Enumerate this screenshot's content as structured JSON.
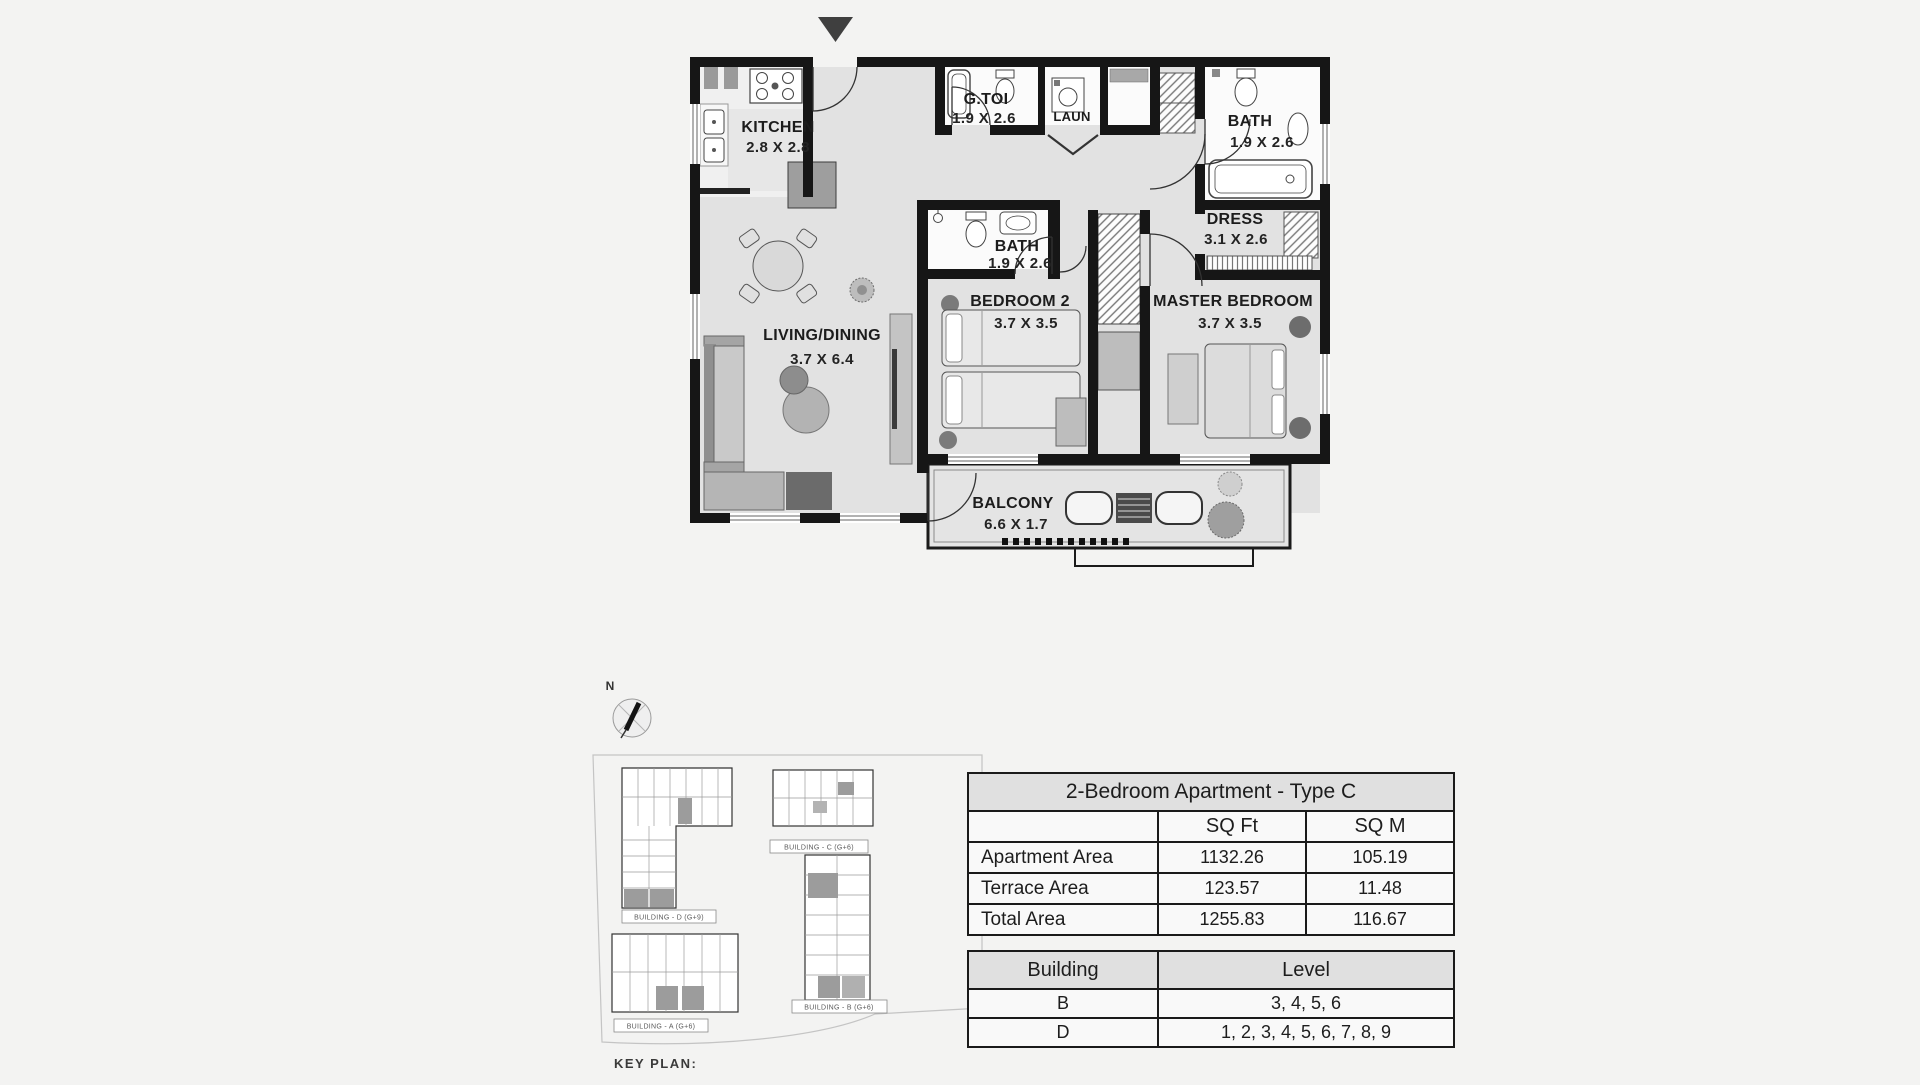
{
  "floor_plan": {
    "entrance_marker": "entrance-arrow",
    "rooms": [
      {
        "id": "kitchen",
        "name": "KITCHEN",
        "dims": "2.8 X 2.8"
      },
      {
        "id": "guest-toilet",
        "name": "G.TOI",
        "dims": "1.9 X 2.6"
      },
      {
        "id": "laundry",
        "name": "LAUN",
        "dims": ""
      },
      {
        "id": "bath-top",
        "name": "BATH",
        "dims": "1.9 X 2.6"
      },
      {
        "id": "dress",
        "name": "DRESS",
        "dims": "3.1 X 2.6"
      },
      {
        "id": "bath-mid",
        "name": "BATH",
        "dims": "1.9 X 2.6"
      },
      {
        "id": "bedroom2",
        "name": "BEDROOM 2",
        "dims": "3.7 X 3.5"
      },
      {
        "id": "master-bedroom",
        "name": "MASTER BEDROOM",
        "dims": "3.7 X 3.5"
      },
      {
        "id": "living-dining",
        "name": "LIVING/DINING",
        "dims": "3.7 X 6.4"
      },
      {
        "id": "balcony",
        "name": "BALCONY",
        "dims": "6.6 X 1.7"
      }
    ]
  },
  "key_plan": {
    "label": "KEY PLAN:",
    "compass": "N",
    "buildings": [
      {
        "label": "BUILDING - C (G+6)"
      },
      {
        "label": "BUILDING - D (G+9)"
      },
      {
        "label": "BUILDING - B (G+6)"
      },
      {
        "label": "BUILDING - A (G+6)"
      }
    ]
  },
  "area_table": {
    "title": "2-Bedroom Apartment - Type C",
    "col1": "SQ Ft",
    "col2": "SQ M",
    "rows": [
      {
        "label": "Apartment Area",
        "sqft": "1132.26",
        "sqm": "105.19"
      },
      {
        "label": "Terrace Area",
        "sqft": "123.57",
        "sqm": "11.48"
      },
      {
        "label": "Total Area",
        "sqft": "1255.83",
        "sqm": "116.67"
      }
    ]
  },
  "building_table": {
    "col1": "Building",
    "col2": "Level",
    "rows": [
      {
        "building": "B",
        "level": "3, 4, 5, 6"
      },
      {
        "building": "D",
        "level": "1, 2, 3, 4, 5, 6, 7, 8, 9"
      }
    ]
  },
  "colors": {
    "wall": "#161616",
    "floor": "#e2e2e2",
    "wet_room": "#fbfbfb",
    "table_header_bg": "#e0e0e0"
  }
}
